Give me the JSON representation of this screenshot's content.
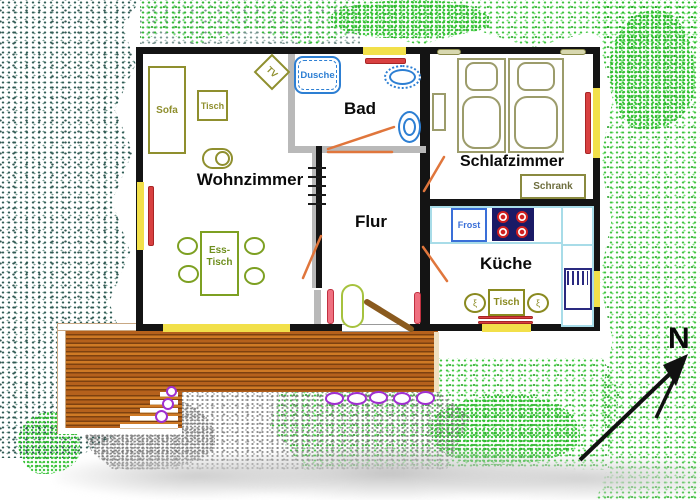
{
  "plan": {
    "rooms": {
      "wohnzimmer": "Wohnzimmer",
      "bad": "Bad",
      "flur": "Flur",
      "schlafzimmer": "Schlafzimmer",
      "kueche": "Küche"
    },
    "furniture": {
      "sofa": "Sofa",
      "tisch_wohnzimmer": "Tisch",
      "tv": "TV",
      "dusche": "Dusche",
      "esstisch_line1": "Ess-",
      "esstisch_line2": "Tisch",
      "schrank": "Schrank",
      "frost": "Frost",
      "tisch_kueche": "Tisch",
      "chair_glyph": "ξ"
    },
    "compass": {
      "north": "N"
    },
    "colors": {
      "wall_black": "#141414",
      "bath_wall_gray": "#b9b9b9",
      "window_yellow": "#f2e04a",
      "curtain_red": "#d84040",
      "door_swing_orange": "#e0763c",
      "entrance_door_brown": "#8a5a1e",
      "fixture_blue": "#2d7fd3",
      "furniture_olive": "#8f8f2e",
      "bed_olive": "#9c9c6b",
      "dining_green": "#7da022",
      "counter_cyan": "#a8dce8",
      "stove_navy": "#1a1a66",
      "sink_navy": "#2a2a80",
      "deck_brown": "#c2681f",
      "stone_purple": "#a030d0",
      "lawn_green": "#2ebf2e",
      "shrub_teal": "#2e5f56",
      "gravel_gray": "#9a9a9a"
    }
  }
}
